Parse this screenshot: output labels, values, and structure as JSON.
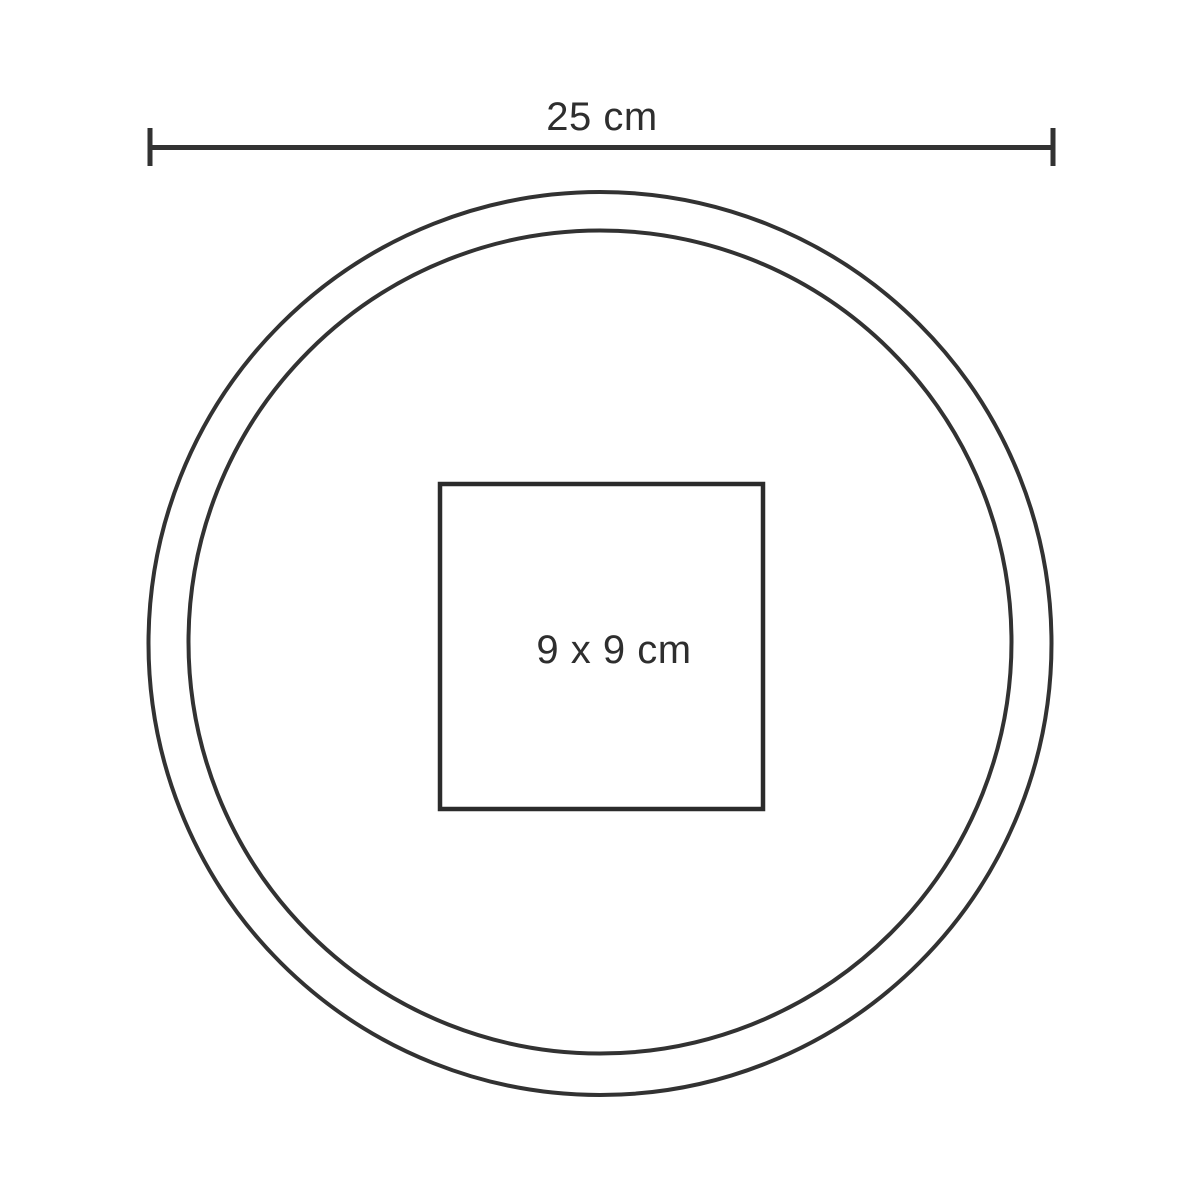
{
  "diagram": {
    "description": "Round product (plate/coaster) top view with overall diameter dimension and centered square print area",
    "diameter_label": "25 cm",
    "print_area_label": "9 x 9 cm"
  },
  "colors": {
    "ink": "#323232",
    "background": "#ffffff"
  }
}
